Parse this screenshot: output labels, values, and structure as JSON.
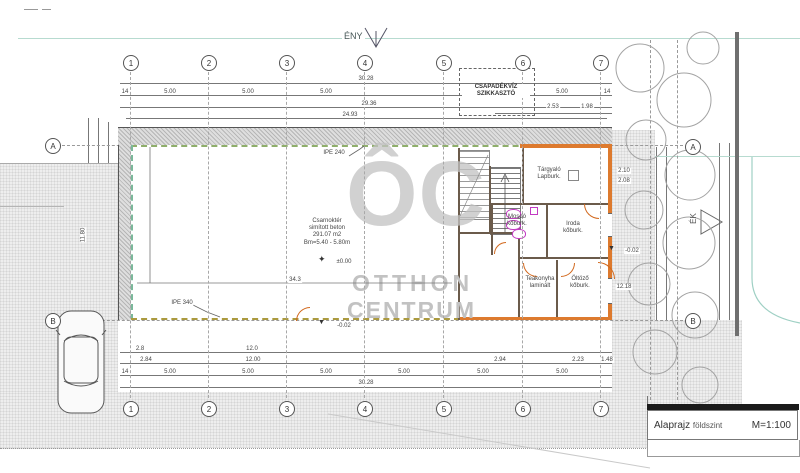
{
  "site": {
    "north_top_label": "ÉNY",
    "north_right_label": "ÉK",
    "infiltrator_line1": "CSAPADÉKVÍZ",
    "infiltrator_line2": "SZIKKASZTÓ"
  },
  "watermark": {
    "logo": "ÔC",
    "name_line1": "OTTHON",
    "name_line2": "CENTRUM"
  },
  "title_block": {
    "drawing_title": "Alaprajz",
    "drawing_subtitle": "földszint",
    "scale": "M=1:100"
  },
  "grid": {
    "columns": [
      "1",
      "2",
      "3",
      "4",
      "5",
      "6",
      "7"
    ],
    "rows": [
      "A",
      "B"
    ]
  },
  "rooms": {
    "hall": {
      "name": "Csarnoktér",
      "finish": "simított beton",
      "area": "291.07 m2",
      "clear_height": "Bm=5.40 - 5.80m"
    },
    "meeting": {
      "name": "Tárgyaló",
      "finish": "Lapburk."
    },
    "washroom": {
      "name": "Mosdó",
      "finish": "kőburk."
    },
    "office": {
      "name": "Iroda",
      "finish": "kőburk."
    },
    "tea_kitchen": {
      "name": "Teakonyha",
      "finish": "laminált"
    },
    "dressing": {
      "name": "Öltöző",
      "finish": "kőburk."
    }
  },
  "annotations": {
    "beam_top": "IPE 240",
    "beam_bottom": "IPE 340",
    "level_zero": "±0.00",
    "level_minus_center": "-0.02",
    "level_minus_right": "-0.02"
  },
  "icons": {
    "level_marker": "✦",
    "level_arrow": "▼"
  },
  "dimensions": {
    "top": {
      "overall": "30.28",
      "bays": [
        "5.00",
        "5.00",
        "5.00",
        "5.00"
      ],
      "sub1": "29.36",
      "sub2": "24.93",
      "end": "14",
      "window1": "2.53",
      "window2": "1.98"
    },
    "bottom": {
      "overall": "30.28",
      "pre1": "2.8",
      "pre2": "12.0",
      "seg1": "2.84",
      "seg2": "12.00",
      "seg3": "2.94",
      "seg4": "2.23",
      "seg5": "1.48",
      "bays": [
        "5.00",
        "5.00",
        "5.00",
        "5.00",
        "5.00",
        "5.00"
      ],
      "end": "14",
      "hall_inner": "34.3"
    },
    "left": {
      "overall": "11.80"
    },
    "right": {
      "window_upper": "2.10",
      "window_lower": "2.08",
      "side": "12.18"
    }
  },
  "colors": {
    "accent_wall": "#dd7a2e",
    "facade_dash": "#8fae6b",
    "fixture": "#c23ac2",
    "site_line": "#b7dbd0",
    "watermark": "#c2c2c2"
  }
}
